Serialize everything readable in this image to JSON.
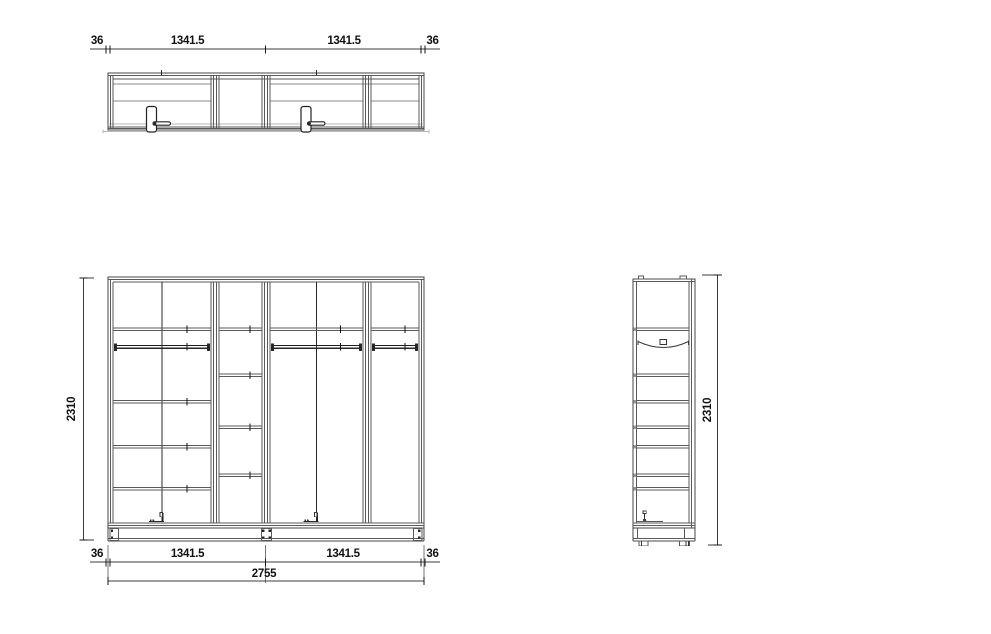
{
  "colors": {
    "background": "#ffffff",
    "line": "#474747",
    "line_dark": "#1f1f1f",
    "line_light": "#b9b9b9",
    "text": "#111111"
  },
  "dimensions": {
    "top": {
      "left": "36",
      "bay1": "1341.5",
      "bay2": "1341.5",
      "right": "36"
    },
    "bottom": {
      "left": "36",
      "bay1": "1341.5",
      "bay2": "1341.5",
      "right": "36",
      "total": "2755"
    },
    "front_height": "2310",
    "side_height": "2310"
  }
}
